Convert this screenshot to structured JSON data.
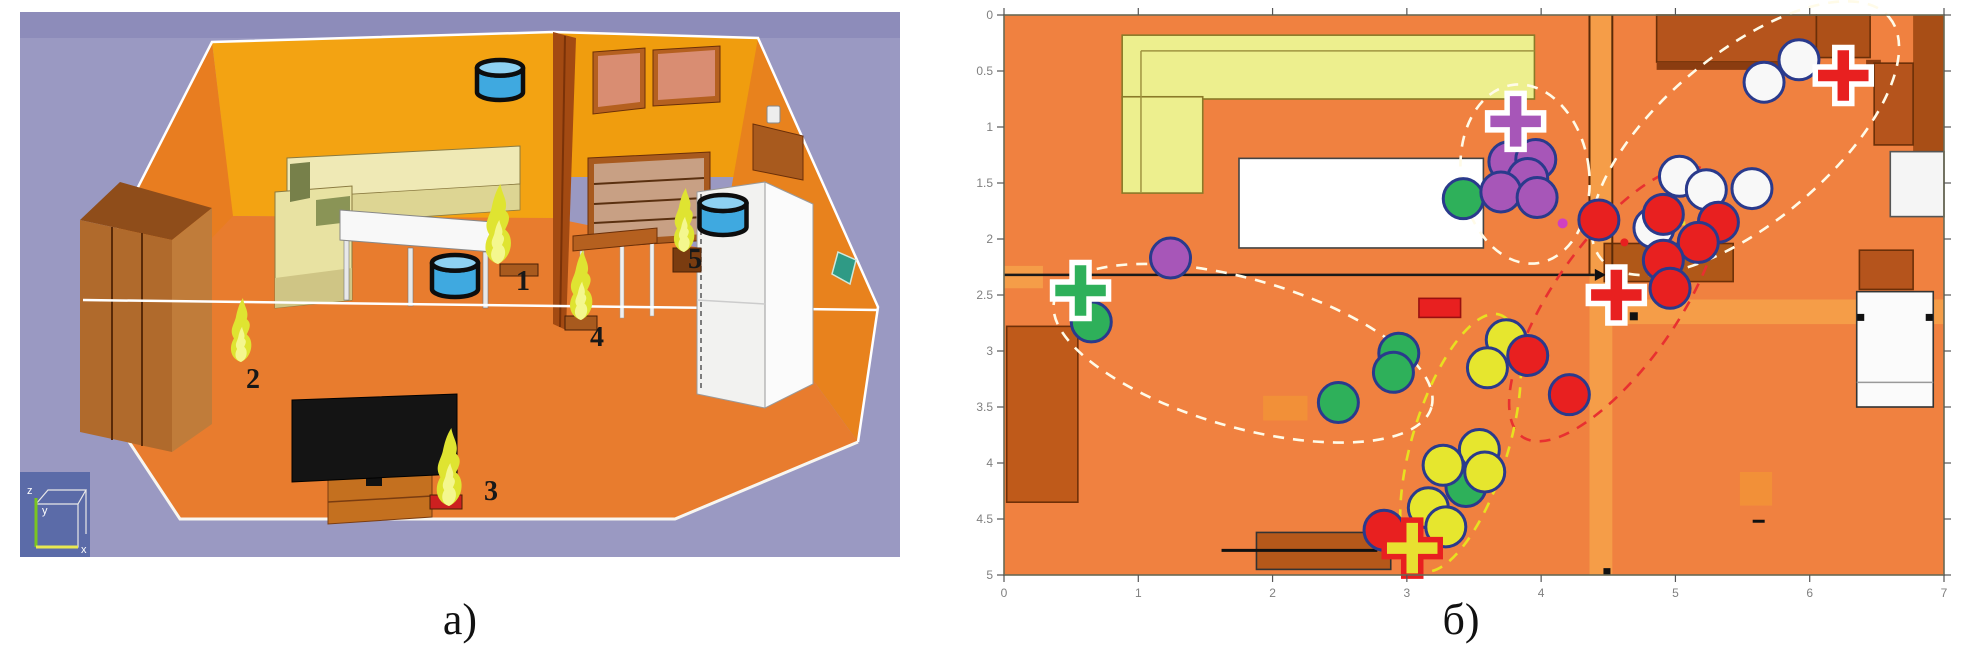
{
  "captions": {
    "a": "а)",
    "b": "б)"
  },
  "left_panel": {
    "description": "3d-room-fire-scene",
    "axis_triad": {
      "z": "z",
      "y": "y",
      "x": "x"
    },
    "fires": [
      {
        "label": "1",
        "cx": 478,
        "base": 252,
        "h": 80,
        "lx": 496,
        "ly": 278,
        "stand": {
          "x": 480,
          "y": 252,
          "w": 38,
          "h": 12,
          "color": "#a85a1e"
        }
      },
      {
        "label": "2",
        "cx": 221,
        "base": 350,
        "h": 64,
        "lx": 226,
        "ly": 376,
        "stand": null
      },
      {
        "label": "3",
        "cx": 429,
        "base": 494,
        "h": 78,
        "lx": 464,
        "ly": 488,
        "stand": {
          "x": 410,
          "y": 483,
          "w": 32,
          "h": 14,
          "color": "#cc2020"
        }
      },
      {
        "label": "4",
        "cx": 561,
        "base": 308,
        "h": 70,
        "lx": 570,
        "ly": 334,
        "stand": {
          "x": 545,
          "y": 304,
          "w": 32,
          "h": 14,
          "color": "#a85a1e"
        }
      },
      {
        "label": "5",
        "cx": 664,
        "base": 240,
        "h": 64,
        "lx": 668,
        "ly": 256,
        "stand": {
          "x": 653,
          "y": 236,
          "w": 28,
          "h": 24,
          "color": "#7a3c10"
        }
      }
    ],
    "cylinders": [
      {
        "cx": 480,
        "cy": 68,
        "w": 46,
        "h": 40
      },
      {
        "cx": 435,
        "cy": 264,
        "w": 46,
        "h": 42
      },
      {
        "cx": 703,
        "cy": 203,
        "w": 47,
        "h": 40
      }
    ],
    "cylinder_colors": {
      "body": "#3fa9e0",
      "top": "#8ed1f2",
      "stroke": "#0d0d0d"
    },
    "flame_colors": {
      "outer": "#dfe431",
      "inner": "#f4f78e"
    }
  },
  "chart_data": {
    "type": "scatter",
    "title": "",
    "xlabel": "",
    "ylabel": "",
    "xlim": [
      0,
      7
    ],
    "ylim": [
      0,
      5
    ],
    "y_inverted": true,
    "grid": false,
    "x_tick_labels": [
      "0",
      "1",
      "2",
      "3",
      "4",
      "5",
      "6",
      "7"
    ],
    "y_tick_labels": [
      "0",
      "0.5",
      "1",
      "1.5",
      "2",
      "2.5",
      "3",
      "3.5",
      "4",
      "4.5",
      "5"
    ],
    "series": [
      {
        "name": "white-particles",
        "color": "#f8f8f8",
        "points": [
          [
            5.92,
            0.4
          ],
          [
            5.66,
            0.6
          ],
          [
            5.03,
            1.44
          ],
          [
            5.23,
            1.56
          ],
          [
            5.57,
            1.55
          ],
          [
            4.84,
            1.9
          ]
        ]
      },
      {
        "name": "green-particles",
        "color": "#2eb05a",
        "points": [
          [
            3.42,
            1.64
          ],
          [
            0.65,
            2.74
          ],
          [
            2.94,
            3.02
          ],
          [
            2.9,
            3.19
          ],
          [
            2.49,
            3.46
          ],
          [
            3.44,
            4.21
          ]
        ]
      },
      {
        "name": "purple-particles",
        "color": "#a756b8",
        "points": [
          [
            1.24,
            2.17
          ],
          [
            3.76,
            1.31
          ],
          [
            3.96,
            1.29
          ],
          [
            3.9,
            1.46
          ],
          [
            3.7,
            1.58
          ],
          [
            3.97,
            1.63
          ]
        ]
      },
      {
        "name": "yellow-particles",
        "color": "#e6e62e",
        "points": [
          [
            3.74,
            2.9
          ],
          [
            3.6,
            3.15
          ],
          [
            3.54,
            3.88
          ],
          [
            3.27,
            4.02
          ],
          [
            3.58,
            4.08
          ],
          [
            3.16,
            4.4
          ],
          [
            3.29,
            4.57
          ]
        ]
      },
      {
        "name": "red-particles",
        "color": "#e82020",
        "points": [
          [
            4.43,
            1.83
          ],
          [
            4.91,
            1.78
          ],
          [
            5.32,
            1.85
          ],
          [
            5.17,
            2.03
          ],
          [
            4.91,
            2.19
          ],
          [
            4.96,
            2.44
          ],
          [
            3.9,
            3.04
          ],
          [
            4.21,
            3.39
          ],
          [
            2.83,
            4.6
          ]
        ]
      }
    ],
    "marker_stroke": "#2a3a8c",
    "crosses": [
      {
        "x": 0.57,
        "y": 2.46,
        "fill": "#2eb05a",
        "outline": "#ffffff"
      },
      {
        "x": 3.81,
        "y": 0.95,
        "fill": "#a756b8",
        "outline": "#ffffff"
      },
      {
        "x": 4.56,
        "y": 2.5,
        "fill": "#e82020",
        "outline": "#ffffff"
      },
      {
        "x": 6.25,
        "y": 0.54,
        "fill": "#e82020",
        "outline": "#ffffff"
      },
      {
        "x": 3.04,
        "y": 4.76,
        "fill": "#e8e030",
        "outline": "#e82020"
      }
    ],
    "ellipses": [
      {
        "cx": 1.78,
        "cy": 3.02,
        "rx": 196,
        "ry": 74,
        "rot": 16,
        "color": "#fffbe8"
      },
      {
        "cx": 3.88,
        "cy": 1.42,
        "rx": 64,
        "ry": 90,
        "rot": -8,
        "color": "#fffbe8"
      },
      {
        "cx": 5.52,
        "cy": 1.1,
        "rx": 188,
        "ry": 84,
        "rot": -40,
        "color": "#fffbe8"
      },
      {
        "cx": 4.55,
        "cy": 2.58,
        "rx": 162,
        "ry": 62,
        "rot": -55,
        "color": "#e83030"
      },
      {
        "cx": 3.4,
        "cy": 3.82,
        "rx": 134,
        "ry": 48,
        "rot": -73,
        "color": "#e8e020"
      }
    ],
    "floor_color": "#f08140",
    "furniture": [
      {
        "name": "door-zone-vertical",
        "x1": 4.36,
        "y1": 0.0,
        "x2": 4.53,
        "y2": 5.0,
        "fill": "#f59d48",
        "stroke": "none"
      },
      {
        "name": "door-zone-horizontal",
        "x1": 4.53,
        "y1": 2.54,
        "x2": 7.0,
        "y2": 2.76,
        "fill": "#f59d48",
        "stroke": "none"
      },
      {
        "name": "door-zone-left",
        "x1": 0.0,
        "y1": 2.24,
        "x2": 0.29,
        "y2": 2.44,
        "fill": "#f59d48",
        "stroke": "none"
      },
      {
        "name": "floor-patch-1",
        "x1": 1.93,
        "y1": 3.4,
        "x2": 2.26,
        "y2": 3.62,
        "fill": "#f29038",
        "stroke": "none"
      },
      {
        "name": "floor-patch-2",
        "x1": 5.48,
        "y1": 4.08,
        "x2": 5.72,
        "y2": 4.38,
        "fill": "#f29038",
        "stroke": "none"
      },
      {
        "name": "sofa-horizontal",
        "x1": 0.88,
        "y1": 0.18,
        "x2": 3.95,
        "y2": 0.75,
        "fill": "#edef8e",
        "stroke": "#8a7a28"
      },
      {
        "name": "sofa-vertical",
        "x1": 0.88,
        "y1": 0.73,
        "x2": 1.48,
        "y2": 1.59,
        "fill": "#edef8e",
        "stroke": "#8a7a28"
      },
      {
        "name": "table",
        "x1": 1.75,
        "y1": 1.28,
        "x2": 3.57,
        "y2": 2.08,
        "fill": "#ffffff",
        "stroke": "#444444"
      },
      {
        "name": "wardrobe-left",
        "x1": 0.02,
        "y1": 2.78,
        "x2": 0.55,
        "y2": 4.35,
        "fill": "#bf5a1a",
        "stroke": "#6f3008"
      },
      {
        "name": "cabinet-row-top",
        "x1": 4.86,
        "y1": 0.0,
        "x2": 6.05,
        "y2": 0.42,
        "fill": "#b5541c",
        "stroke": "#6b2f08"
      },
      {
        "name": "cabinet-row-top-2",
        "x1": 6.05,
        "y1": 0.0,
        "x2": 6.45,
        "y2": 0.38,
        "fill": "#ad5018",
        "stroke": "#6b2f08"
      },
      {
        "name": "cabinet-under-strip",
        "x1": 4.86,
        "y1": 0.42,
        "x2": 5.97,
        "y2": 0.49,
        "fill": "#8a3c10",
        "stroke": "none"
      },
      {
        "name": "cabinet-small-sq",
        "x1": 6.42,
        "y1": 0.4,
        "x2": 6.53,
        "y2": 0.48,
        "fill": "#8a3c10",
        "stroke": "none"
      },
      {
        "name": "right-wall-strip",
        "x1": 6.77,
        "y1": 0.0,
        "x2": 7.0,
        "y2": 1.22,
        "fill": "#a84e16",
        "stroke": "none"
      },
      {
        "name": "right-column-cabinet",
        "x1": 6.48,
        "y1": 0.43,
        "x2": 6.77,
        "y2": 1.16,
        "fill": "#b5541c",
        "stroke": "#6b2f08"
      },
      {
        "name": "right-window-upper",
        "x1": 6.6,
        "y1": 1.22,
        "x2": 7.0,
        "y2": 1.8,
        "fill": "#f5f5f5",
        "stroke": "#555555"
      },
      {
        "name": "right-mid-cabinet",
        "x1": 6.37,
        "y1": 2.1,
        "x2": 6.77,
        "y2": 2.45,
        "fill": "#b5541c",
        "stroke": "#6b2f08"
      },
      {
        "name": "right-window-lower",
        "x1": 6.35,
        "y1": 2.47,
        "x2": 6.92,
        "y2": 3.5,
        "fill": "#fbfbfb",
        "stroke": "#333333"
      },
      {
        "name": "divider-cabinet",
        "x1": 4.47,
        "y1": 2.04,
        "x2": 5.43,
        "y2": 2.38,
        "fill": "#b05818",
        "stroke": "#6b2f08"
      },
      {
        "name": "red-rect",
        "x1": 3.09,
        "y1": 2.53,
        "x2": 3.4,
        "y2": 2.7,
        "fill": "#e82020",
        "stroke": "#991010"
      },
      {
        "name": "tv-stand",
        "x1": 1.88,
        "y1": 4.62,
        "x2": 2.88,
        "y2": 4.95,
        "fill": "#b5581a",
        "stroke": "#333333"
      }
    ],
    "lines": [
      {
        "name": "sofa-seam-h",
        "x1": 1.02,
        "y1": 0.32,
        "x2": 3.95,
        "y2": 0.32,
        "color": "#a09440",
        "w": 1.5
      },
      {
        "name": "sofa-seam-v",
        "x1": 1.02,
        "y1": 0.32,
        "x2": 1.02,
        "y2": 1.59,
        "color": "#a09440",
        "w": 1.5
      },
      {
        "name": "window-seam",
        "x1": 6.35,
        "y1": 3.28,
        "x2": 6.92,
        "y2": 3.28,
        "color": "#999999",
        "w": 1.5
      },
      {
        "name": "divider-wall-1",
        "x1": 4.36,
        "y1": 0.0,
        "x2": 4.36,
        "y2": 2.32,
        "color": "#5a2a08",
        "w": 2
      },
      {
        "name": "divider-wall-2",
        "x1": 4.53,
        "y1": 0.0,
        "x2": 4.53,
        "y2": 2.32,
        "color": "#5a2a08",
        "w": 2
      },
      {
        "name": "main-wall-line",
        "x1": 0.0,
        "y1": 2.32,
        "x2": 4.4,
        "y2": 2.32,
        "color": "#1a1a1a",
        "w": 2.5
      },
      {
        "name": "tv-edge-line",
        "x1": 1.62,
        "y1": 4.78,
        "x2": 2.78,
        "y2": 4.78,
        "color": "#111111",
        "w": 3
      }
    ],
    "marks": [
      {
        "type": "arrow",
        "x": 4.4,
        "y": 2.32,
        "color": "#111111"
      },
      {
        "type": "sq",
        "x": 4.69,
        "y": 2.69,
        "s": 8,
        "color": "#111111"
      },
      {
        "type": "sq",
        "x": 4.49,
        "y": 4.97,
        "s": 7,
        "color": "#111111"
      },
      {
        "type": "sq",
        "x": 5.27,
        "y": 1.47,
        "s": 8,
        "color": "#111111"
      },
      {
        "type": "sq",
        "x": 6.38,
        "y": 2.7,
        "s": 7,
        "color": "#111111"
      },
      {
        "type": "sq",
        "x": 6.89,
        "y": 2.7,
        "s": 7,
        "color": "#111111"
      },
      {
        "type": "dash",
        "x": 5.62,
        "y": 4.52,
        "wd": 12,
        "ht": 3,
        "color": "#111111"
      },
      {
        "type": "dash",
        "x": 5.04,
        "y": 1.86,
        "wd": 9,
        "ht": 4,
        "color": "#e8e030"
      },
      {
        "type": "dot",
        "x": 4.62,
        "y": 2.03,
        "r": 4,
        "color": "#e82020"
      },
      {
        "type": "dot",
        "x": 4.16,
        "y": 1.86,
        "r": 5,
        "color": "#d040c0"
      }
    ],
    "axis_color": "#6a6a55",
    "tick_label_color": "#808080"
  }
}
